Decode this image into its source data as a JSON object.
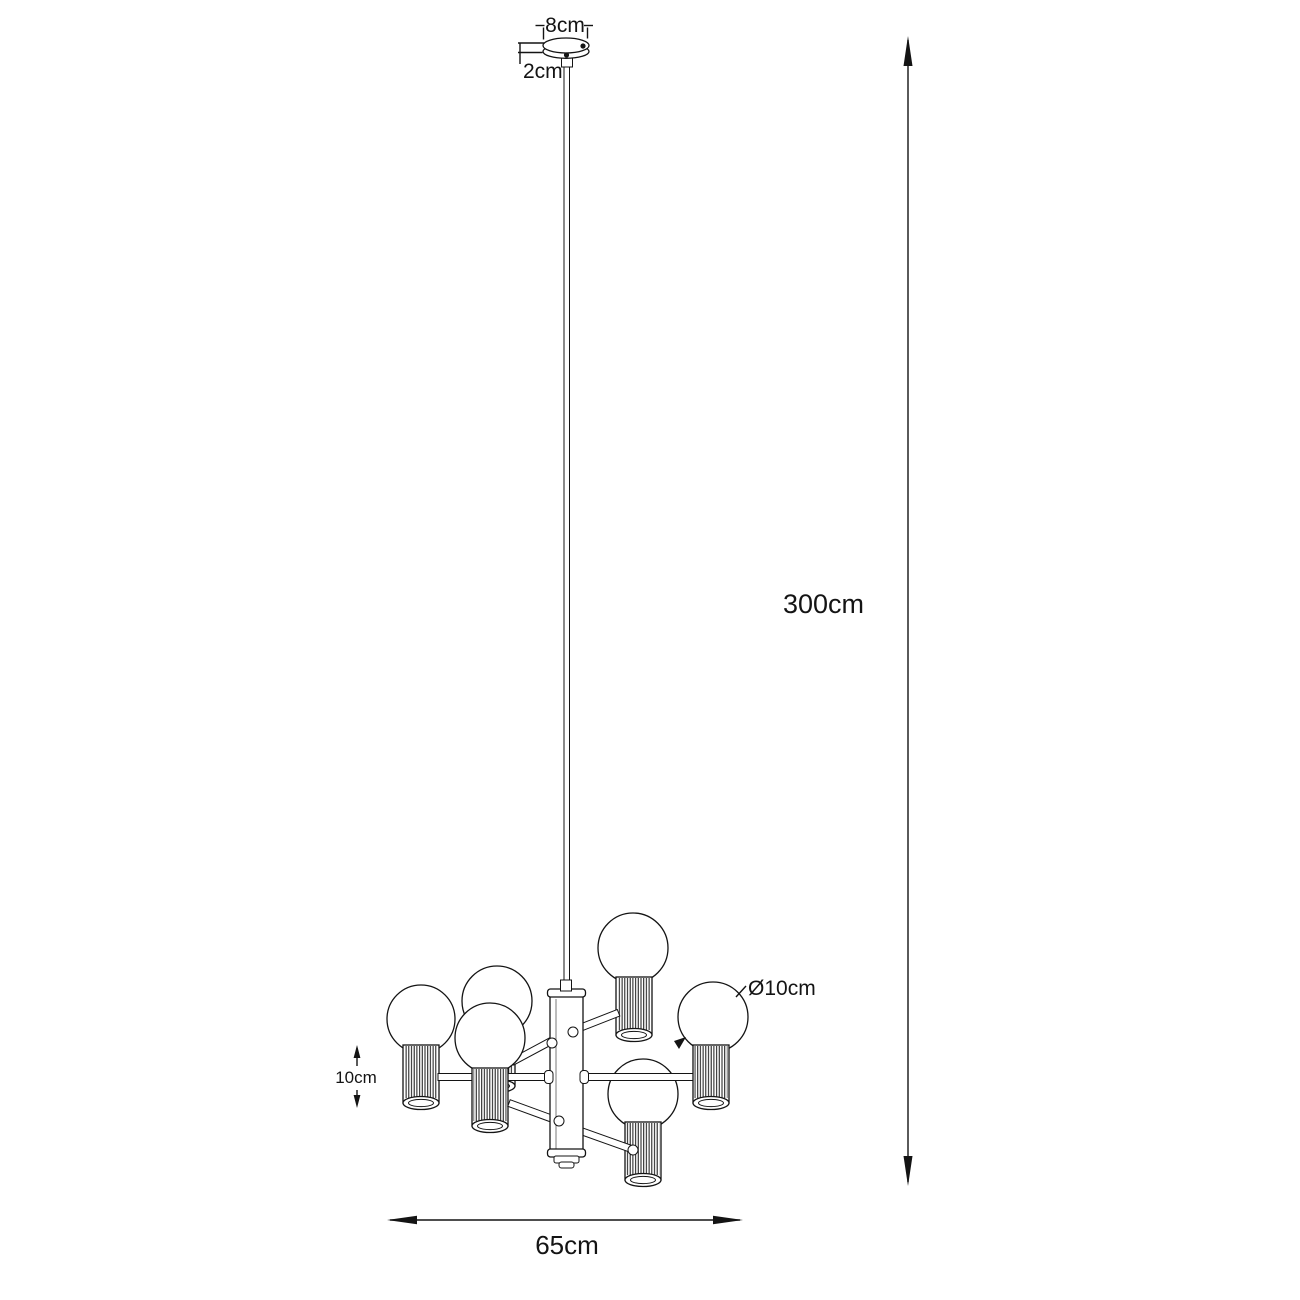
{
  "figure": {
    "subject": "pendant-chandelier-dimension-drawing",
    "background_color": "#ffffff",
    "line_color": "#141414",
    "num_lights": 6,
    "labels": {
      "canopy_width": "8cm",
      "canopy_height": "2cm",
      "drop_height": "300cm",
      "fixture_width": "65cm",
      "shade_height": "10cm",
      "bulb_diameter": "Ø10cm"
    }
  }
}
